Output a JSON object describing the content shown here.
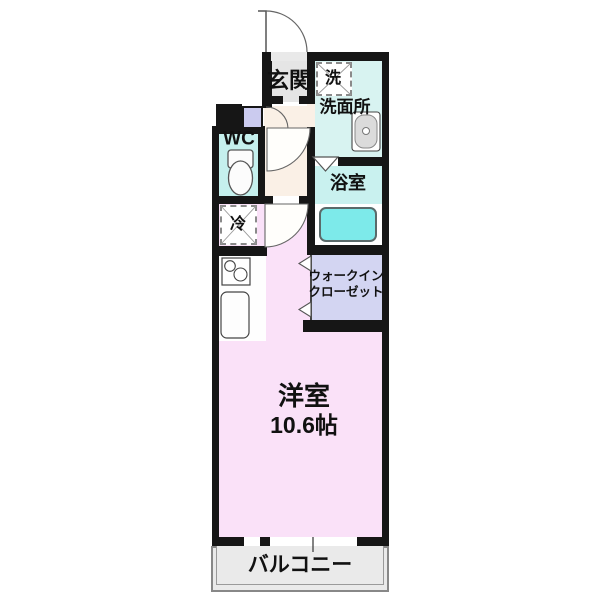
{
  "plan": {
    "type": "apartment-floor-plan",
    "rooms": {
      "genkan": {
        "label": "玄関"
      },
      "washroom": {
        "label": "洗面所"
      },
      "washer_space": {
        "label": "洗"
      },
      "wc": {
        "label": "WC"
      },
      "bathroom": {
        "label": "浴室"
      },
      "fridge_space": {
        "label": "冷"
      },
      "walk_in_closet": {
        "label_line1": "ウォークイン",
        "label_line2": "クローゼット"
      },
      "main_room": {
        "label": "洋室",
        "size": "10.6帖"
      },
      "balcony": {
        "label": "バルコニー"
      }
    },
    "colors": {
      "wall": "#161616",
      "main_room_pink": "#FAE1F8",
      "hallway_cream": "#FAF0E6",
      "genkan_gray": "#E5E5E5",
      "washroom_cyan": "#D8F3F1",
      "wc_cyan": "#C5F0ED",
      "bath_cyan": "#C9F1EF",
      "bathtub_cyan": "#7DEAEA",
      "closet_lavender": "#D3D5F2",
      "shoe_box_lavender": "#CBCBEF",
      "balcony_gray": "#EAEAEA"
    }
  }
}
